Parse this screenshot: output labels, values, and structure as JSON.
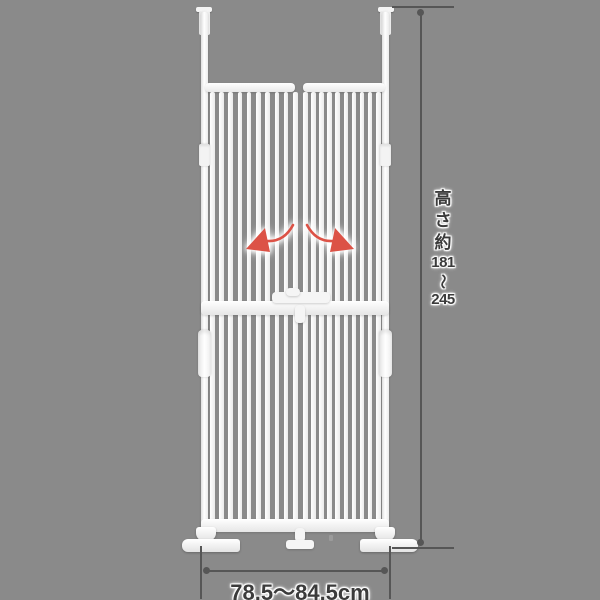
{
  "annotations": {
    "height": {
      "text": "高さ約181〜245",
      "chars": [
        "高",
        "さ",
        "約",
        "181",
        "〜",
        "245"
      ]
    },
    "width": {
      "text": "78.5〜84.5cm"
    }
  },
  "colors": {
    "background": "#8a8a8a",
    "gate_white": "#f8f8f8",
    "arrow_red": "#dc5246",
    "dimension_line": "#565656",
    "annotation_text": "#3b3b3b"
  },
  "gate": {
    "panel_count": 2,
    "bars_per_panel": 10
  },
  "icons": {
    "swing_left": "swing-arrow-left",
    "swing_right": "swing-arrow-right"
  }
}
